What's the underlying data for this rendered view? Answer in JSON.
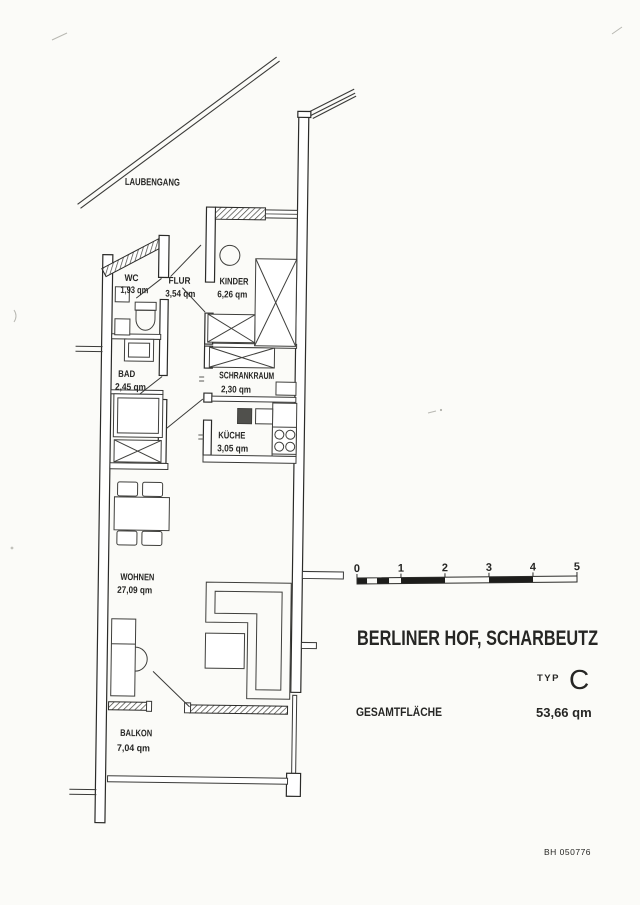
{
  "document": {
    "walkway_label": "LAUBENGANG",
    "project_title": "BERLINER HOF, SCHARBEUTZ",
    "type_label": "TYP",
    "type_value": "C",
    "total_area_label": "GESAMTFLÄCHE",
    "total_area_value": "53,66 qm",
    "drawing_number": "BH 050776"
  },
  "rooms": {
    "wc": {
      "name": "WC",
      "area": "1,93 qm"
    },
    "flur": {
      "name": "FLUR",
      "area": "3,54 qm"
    },
    "kinder": {
      "name": "KINDER",
      "area": "6,26 qm"
    },
    "bad": {
      "name": "BAD",
      "area": "2,45 qm"
    },
    "schrankraum": {
      "name": "SCHRANKRAUM",
      "area": "2,30 qm"
    },
    "kueche": {
      "name": "KÜCHE",
      "area": "3,05 qm"
    },
    "wohnen": {
      "name": "WOHNEN",
      "area": "27,09 qm"
    },
    "balkon": {
      "name": "BALKON",
      "area": "7,04 qm"
    }
  },
  "scale_bar": {
    "labels": [
      "0",
      "1",
      "2",
      "3",
      "4",
      "5"
    ]
  },
  "colors": {
    "ink": "#2b2b29",
    "paper": "#fbfbf8",
    "faint_print": "#97978f"
  }
}
